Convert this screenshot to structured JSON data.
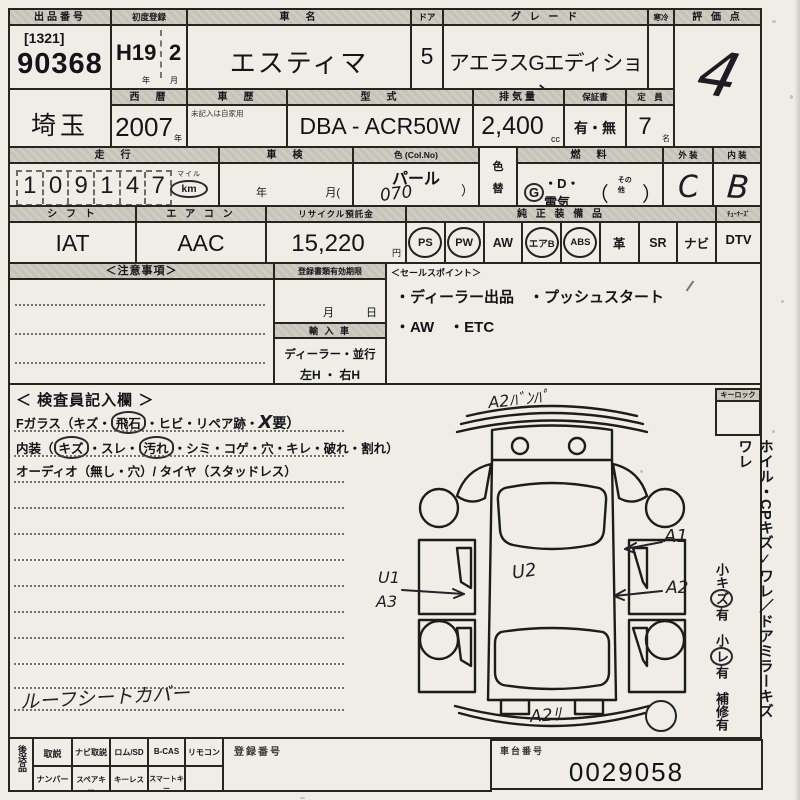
{
  "r1": {
    "lot_label": "出品番号",
    "lot_bracket": "[1321]",
    "lot_no": "90368",
    "reg_label": "初度登録",
    "reg_era": "H19",
    "reg_month": "2",
    "reg_unit_y": "年",
    "reg_unit_m": "月",
    "name_label": "車　名",
    "name_value": "エスティマ",
    "door_label": "ドア",
    "door_value": "5",
    "grade_label": "グ レ ー ド",
    "grade_value": "アエラスGエディション",
    "cold_label": "寒冷",
    "score_label": "評 価 点",
    "score_value": "4"
  },
  "r2": {
    "pref_value": "埼玉",
    "year_label": "西　暦",
    "year_value": "2007",
    "year_unit": "年",
    "hist_label": "車　歴",
    "hist_note": "未記入は自家用",
    "model_label": "型　式",
    "model_value": "DBA - ACR50W",
    "disp_label": "排気量",
    "disp_value": "2,400",
    "disp_unit": "cc",
    "warr_label": "保証書",
    "warr_value": "有・無",
    "cap_label": "定　員",
    "cap_value": "7",
    "cap_unit": "名"
  },
  "r3": {
    "mileage_label": "走　行",
    "digits": [
      "1",
      "0",
      "9",
      "1",
      "4",
      "7"
    ],
    "mile_unit": "マイル",
    "km_unit": "km",
    "shaken_label": "車　検",
    "shaken_y": "年",
    "shaken_m": "月(",
    "color_label": "色 (Col.No)",
    "color_value": "パール",
    "color_no": "070",
    "color_paren": "）",
    "colorchg_top": "色",
    "colorchg_bottom": "替",
    "fuel_label": "燃　料",
    "fuel_g": "G",
    "fuel_rest": "・D・電気",
    "fuel_open": "（",
    "fuel_other": "その他",
    "fuel_close": "）",
    "ext_label": "外 装",
    "ext_value": "C",
    "int_label": "内 装",
    "int_value": "B"
  },
  "r4": {
    "shift_label": "シ フ ト",
    "shift_value": "IAT",
    "ac_label": "エ ア コ ン",
    "ac_value": "AAC",
    "recycle_label": "リサイクル預託金",
    "recycle_value": "15,220",
    "recycle_unit": "円",
    "equip_label": "純 正 装 備 品",
    "equipment": [
      {
        "label": "PS",
        "circled": true
      },
      {
        "label": "PW",
        "circled": true
      },
      {
        "label": "AW",
        "circled": false
      },
      {
        "label": "エアB",
        "circled": true
      },
      {
        "label": "ABS",
        "circled": true
      },
      {
        "label": "革",
        "circled": false
      },
      {
        "label": "SR",
        "circled": false
      },
      {
        "label": "ナビ",
        "circled": false
      }
    ],
    "dtv_header": "ﾁｭｰﾅｰｽﾞ",
    "dtv_label": "DTV"
  },
  "r5": {
    "notes_label": "＜注意事項＞",
    "docs_label": "登録書類有効期限",
    "docs_month": "月",
    "docs_day": "日",
    "import_label": "輸 入 車",
    "import_type": "ディーラー・並行",
    "handle": "左H ・ 右H",
    "sales_label": "＜セールスポイント＞",
    "sales_line1": "・ディーラー出品　・プッシュスタート",
    "sales_line2": "・AW　・ETC"
  },
  "r6": {
    "title": "＜ 検査員記入欄 ＞",
    "glass_a": "Fガラス（キズ・",
    "glass_circle": "飛石",
    "glass_b": "・ヒビ・リペア跡・",
    "glass_x": "X",
    "glass_c": "要）",
    "int_a": "内装（",
    "int_circle1": "キズ",
    "int_b": "・スレ・",
    "int_circle2": "汚れ",
    "int_c": "・シミ・コゲ・穴・キレ・破れ・割れ）",
    "audio_line": "オーディオ（無し・穴）/ タイヤ（スタッドレス）",
    "hand_note": "ルーフシートカバー",
    "labels": {
      "front": "A2ﾊﾞﾝﾊﾟ",
      "a1": "A1",
      "a2": "A2",
      "u1": "U1",
      "a3": "A3",
      "u2": "U2",
      "rear": "A2ﾘ"
    },
    "keylock": "キーロック",
    "side1_a": "ホイル・CPキズ",
    "side1_check": "✓",
    "side1_b": "ワレ／ドアミラーキズ ワレ",
    "side2_a": "小キ",
    "side2_c1": "ズ",
    "side2_b": "有　小",
    "side2_c2": "レ",
    "side2_c": "有　補修有"
  },
  "r7": {
    "send_label": "後送品",
    "cols_top": [
      "取説",
      "ナビ取説",
      "ロム/SD",
      "B-CAS",
      "リモコン"
    ],
    "docs_label": "登録番号",
    "cols_bottom": [
      "ナンバー",
      "スペアキー",
      "キーレス",
      "スマートキー"
    ],
    "chassis_label": "車台番号",
    "chassis_value": "0029058"
  }
}
